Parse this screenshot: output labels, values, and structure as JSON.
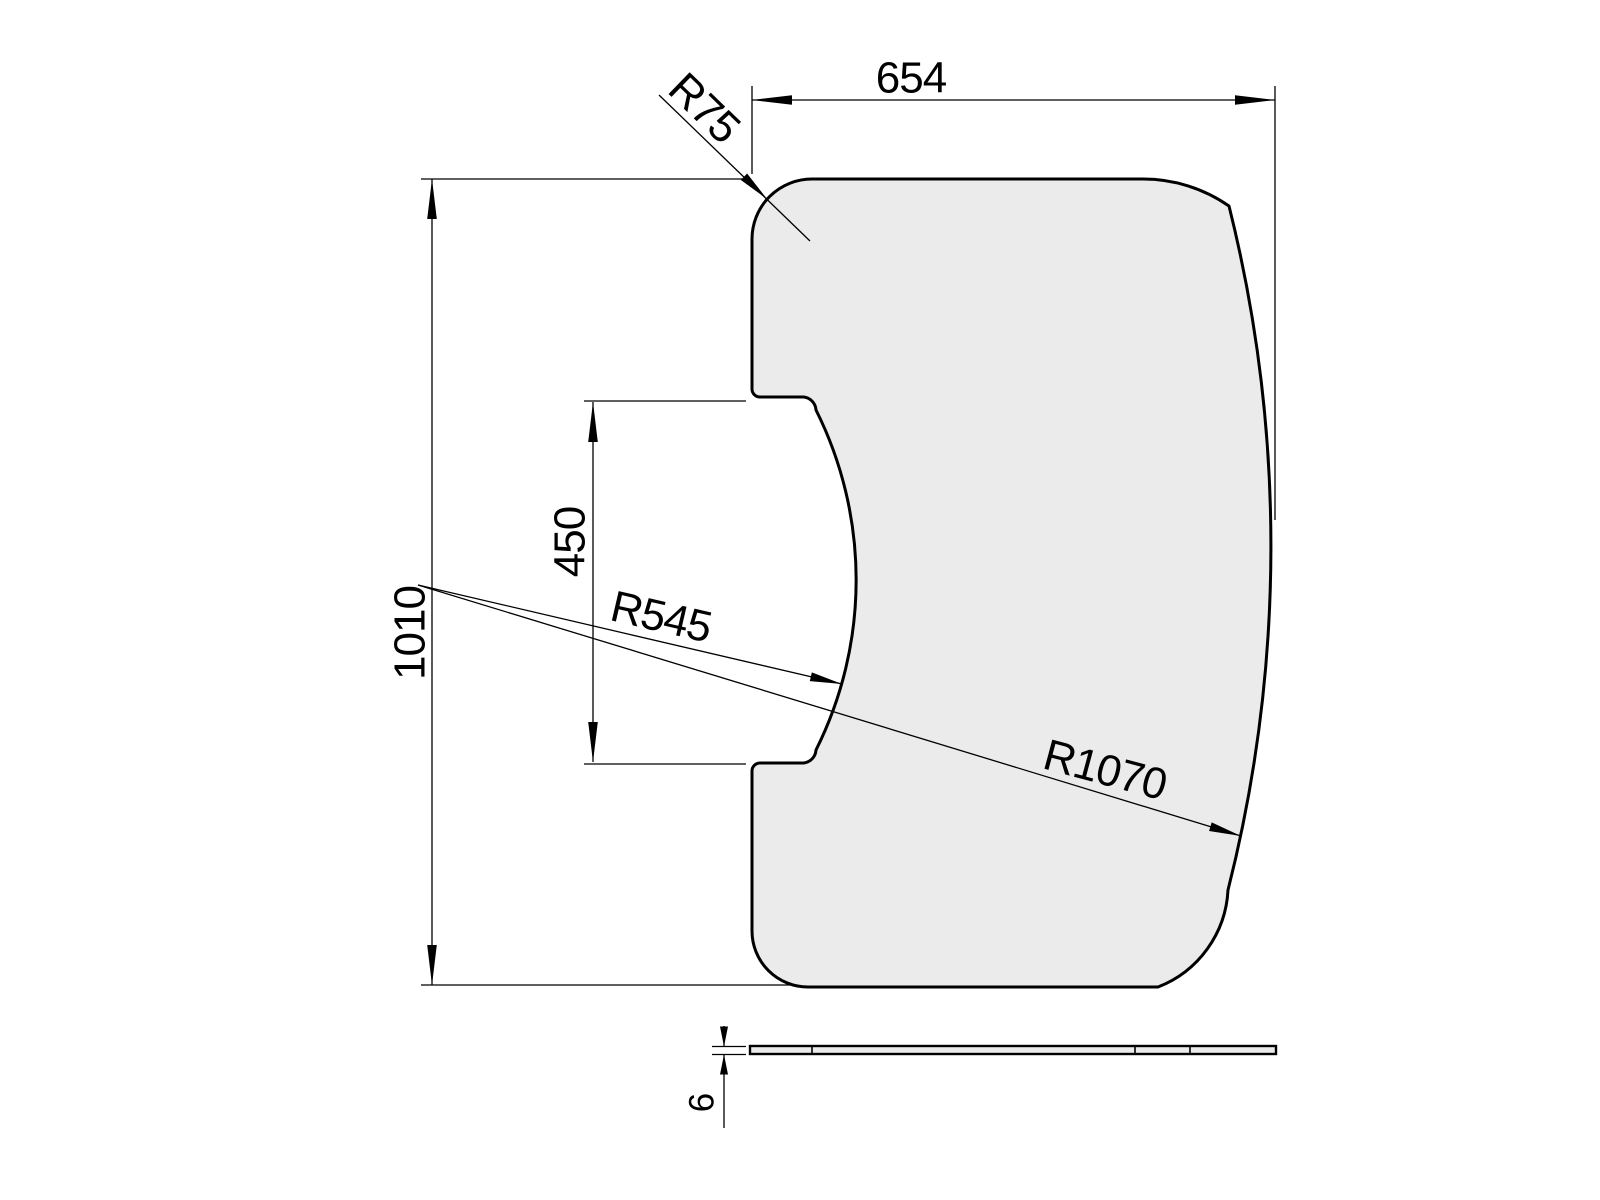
{
  "drawing": {
    "background_color": "#ffffff",
    "part_fill_color": "#ebebeb",
    "line_color": "#000000",
    "front_view": {
      "dim_width": "654",
      "dim_height": "1010",
      "dim_cutout_height": "450",
      "dim_corner_radius": "R75",
      "dim_cutout_radius": "R545",
      "dim_side_radius": "R1070"
    },
    "side_view": {
      "dim_thickness": "6"
    }
  }
}
